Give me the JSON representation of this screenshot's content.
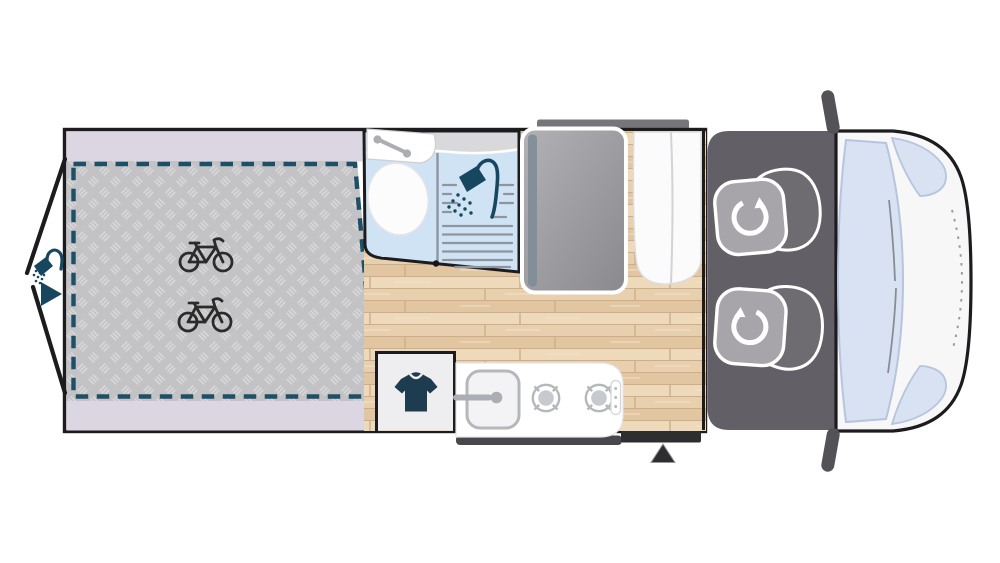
{
  "page": {
    "title": "Campervan floor plan (top view)",
    "background": "#ffffff"
  },
  "palette": {
    "outline": "#1c1b1e",
    "body_white": "#ffffff",
    "lavender": "#dcd6e2",
    "checker_bg": "#c3c3c6",
    "checker_mark": "#d8d8db",
    "dash_teal": "#1d4f66",
    "teal_icon": "#17475f",
    "wood_1": "#e8d0ae",
    "wood_2": "#e2c6a1",
    "wood_3": "#eed9ba",
    "wood_line": "#cdae88",
    "bath_blue": "#cfe3f5",
    "bath_gray": "#d9d9db",
    "line_gray": "#8e959d",
    "bed_1": "#b2b1b5",
    "bed_2": "#8a898d",
    "bed_strip": "#7e8d97",
    "mat": "#626066",
    "seat": "#a7a5a9",
    "seat_back": "#6f6c71",
    "band_top": "#767579",
    "band_dark": "#2e2d30",
    "van_white": "#f7f7f8",
    "window_blue": "#d8e2f2",
    "window_edge": "#b6c5dd",
    "mirror": "#545157",
    "wardrobe": "#eeedef",
    "shirt": "#1e3c4f",
    "ink": "#2b2b2b",
    "counter_shadow": "#48474b",
    "fixture_gray": "#b4b7bb",
    "fixture_fill": "#c6c9cd",
    "faucet": "#abaeb2"
  },
  "floorplan": {
    "rear_garage": {
      "bike_count": 2,
      "rear_doors": "open",
      "exterior_shower": true,
      "floor": "checker-plate"
    },
    "bathroom": {
      "fixtures": [
        "washbasin",
        "toilet",
        "shower"
      ]
    },
    "lounge": {
      "drop_down_bed": true,
      "sofa": true
    },
    "wardrobe": {
      "icon": "t-shirt"
    },
    "kitchen": {
      "sink": true,
      "hob_burners": 2,
      "control_knobs": 3
    },
    "cab": {
      "swivel_seats": 2,
      "mirrors": 2
    },
    "entry": {
      "side": "bottom",
      "marker": "arrow"
    },
    "sliding_door": {
      "side": "top"
    }
  }
}
